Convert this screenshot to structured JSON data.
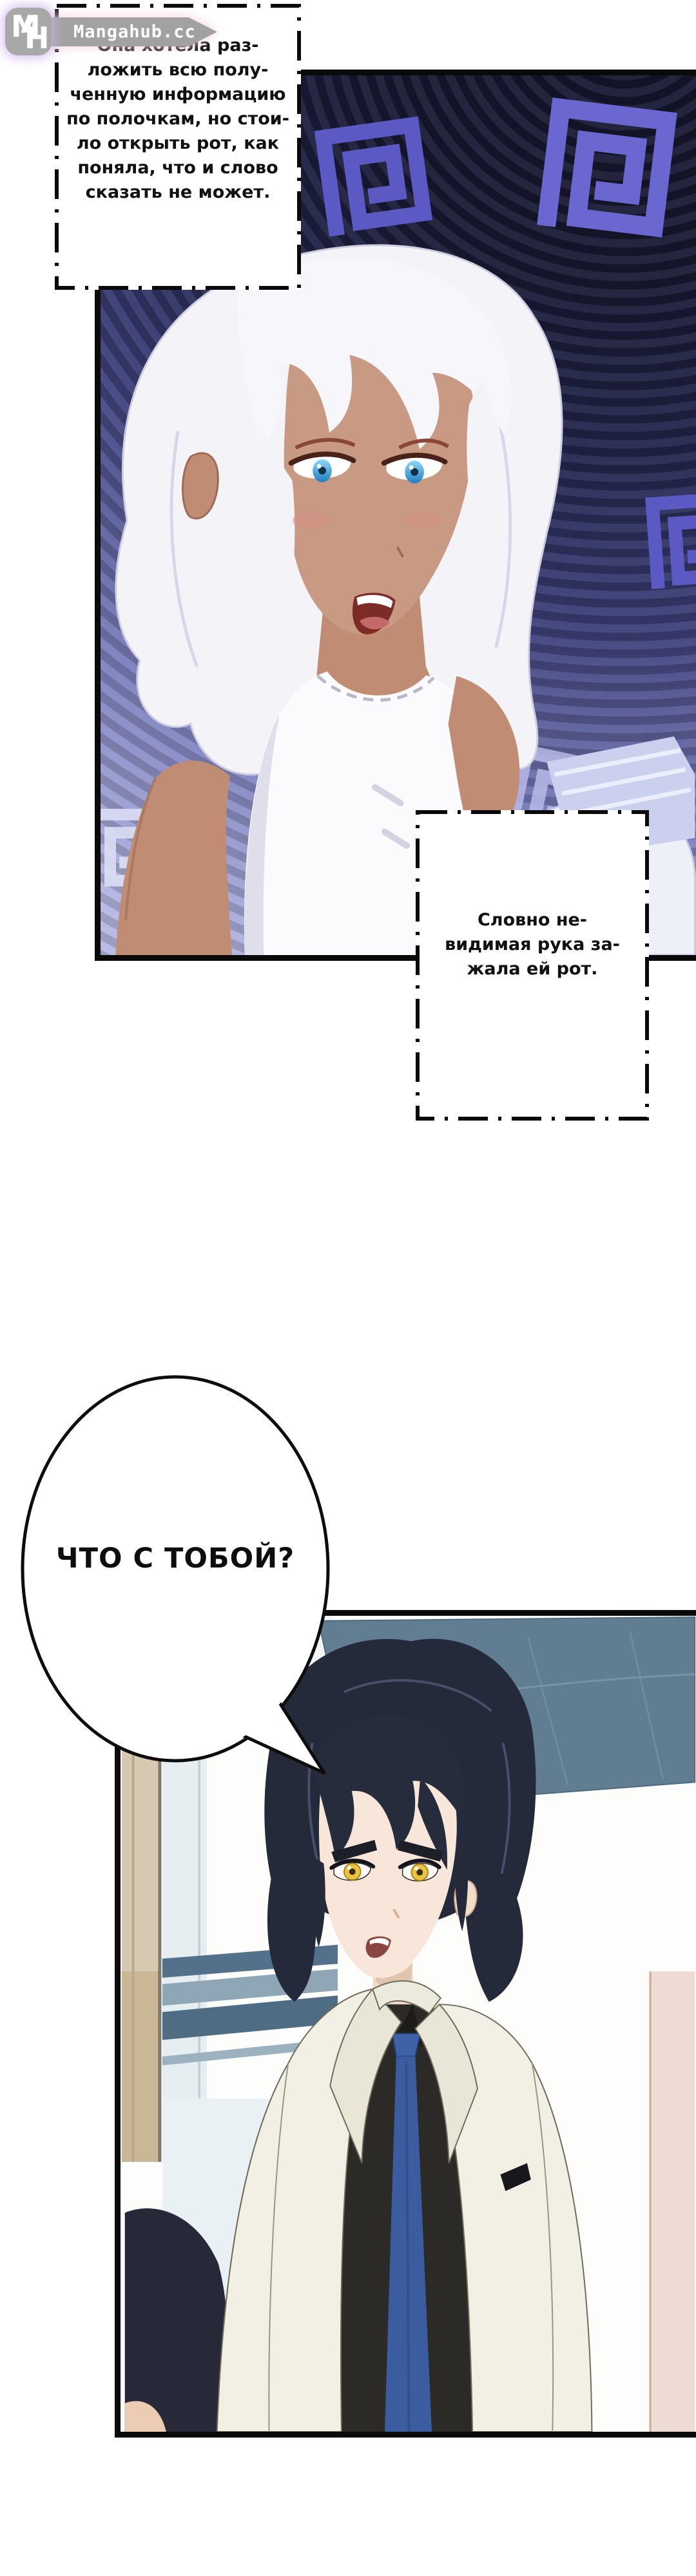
{
  "site": {
    "name": "Mangahub.cc",
    "badge_m": "M",
    "badge_h": "H"
  },
  "captions": {
    "box1": {
      "lines": [
        "Она хотела раз-",
        "ложить всю полу-",
        "ченную информацию",
        "по полочкам, но стои-",
        "ло открыть рот, как",
        "поняла, что и слово",
        "сказать не может."
      ]
    },
    "box2": {
      "lines": [
        "Словно не-",
        "видимая рука за-",
        "жала ей рот."
      ]
    }
  },
  "bubble": {
    "text": "ЧТО С ТОБОЙ?"
  },
  "panels": {
    "panel1": {
      "alt": "hypnosis-spiral-panel-white-haired-woman"
    },
    "panel2": {
      "alt": "black-haired-man-white-coat-panel"
    }
  },
  "colors": {
    "spiral_glyph": "#6a68d0",
    "panel1_bg_dark": "#15152a",
    "panel1_bg_light": "#bcc0e6",
    "girl_skin": "#c89a83",
    "girl_eyes": "#4fc0f0",
    "man_hair": "#252a3a",
    "man_eyes": "#e9c43c",
    "tie_blue": "#3b5c9e",
    "coat_white": "#f2efe5",
    "ceiling_gray_blue": "#607d92",
    "watermark_gray": "#a2a2a2",
    "glow_pink": "#f6cfe2"
  }
}
